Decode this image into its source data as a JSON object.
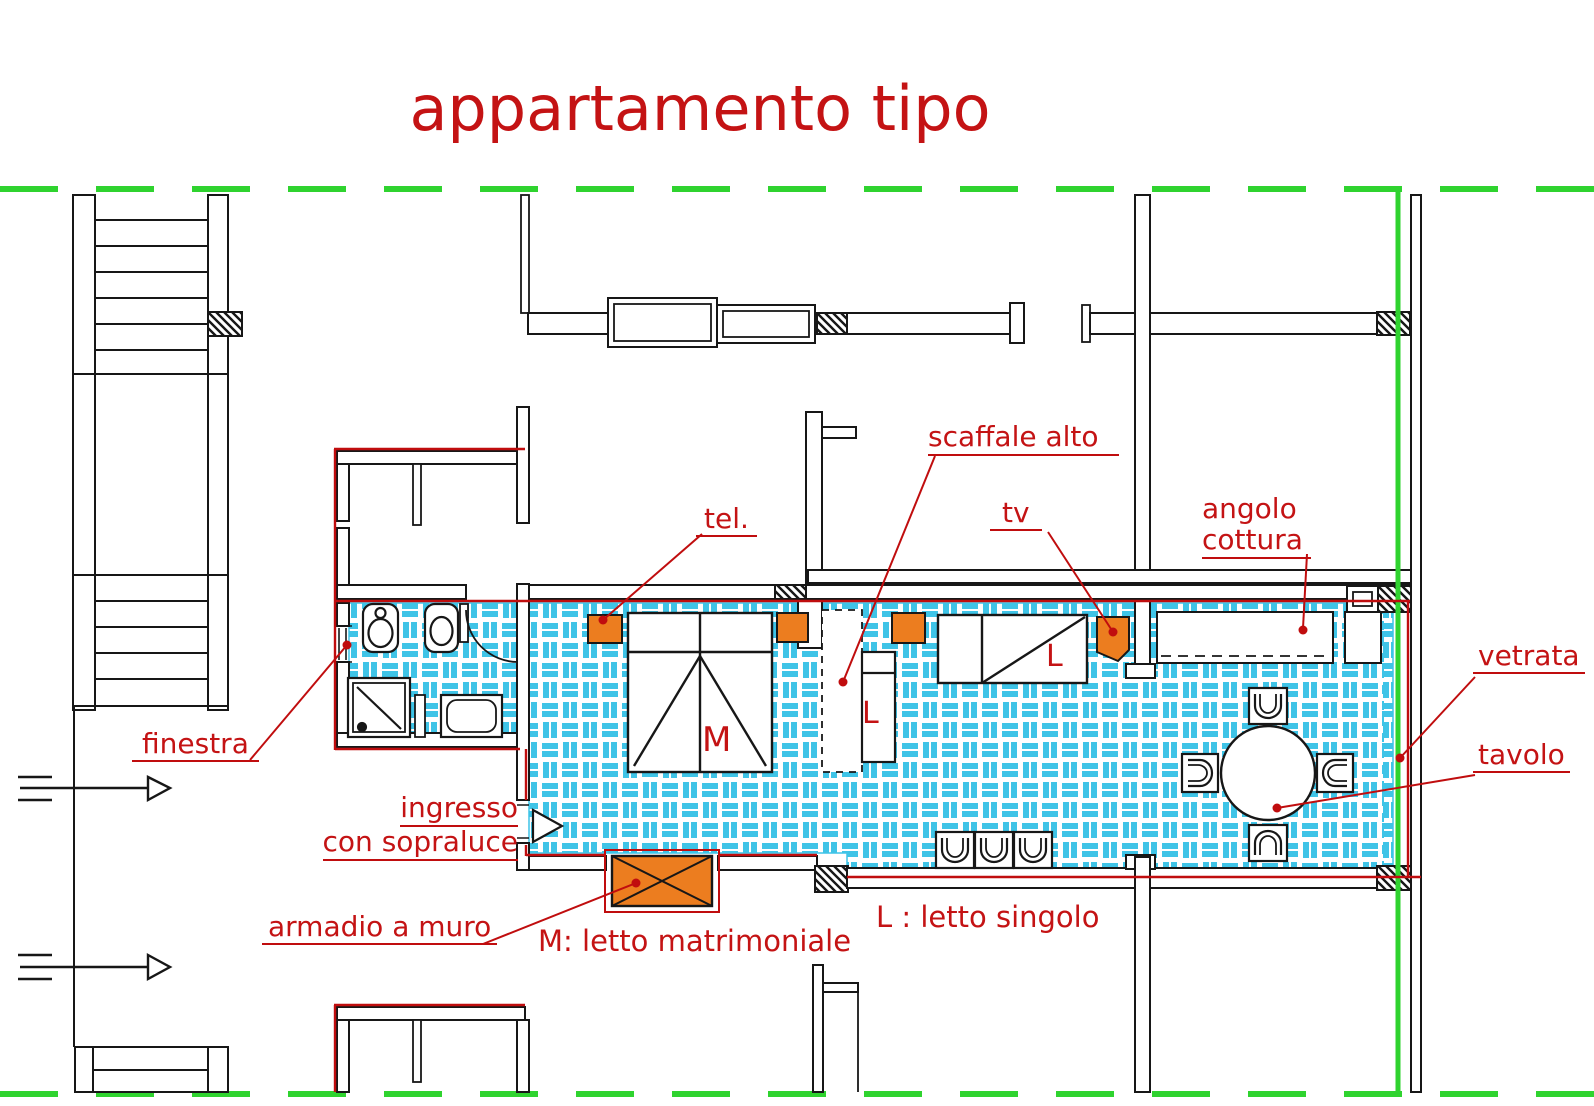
{
  "title": "appartamento tipo",
  "plan": {
    "labels": {
      "finestra": "finestra",
      "ingresso_1": "ingresso",
      "ingresso_2": "con sopraluce",
      "armadio": "armadio a muro",
      "tel": "tel.",
      "scaffale": "scaffale alto",
      "tv": "tv",
      "angolo_1": "angolo",
      "angolo_2": "cottura",
      "vetrata": "vetrata",
      "tavolo": "tavolo"
    },
    "room_letters": {
      "m": "M",
      "l_single_1": "L",
      "l_single_2": "L"
    },
    "legend": {
      "double_bed": "M: letto matrimoniale",
      "single_bed": "L : letto singolo"
    }
  },
  "colors": {
    "red_text": "#c41314",
    "red_line": "#c00d0e",
    "green": "#2fd32f",
    "orange": "#ec7d1f",
    "tile": "#3fc4e7",
    "wall": "#171717"
  }
}
